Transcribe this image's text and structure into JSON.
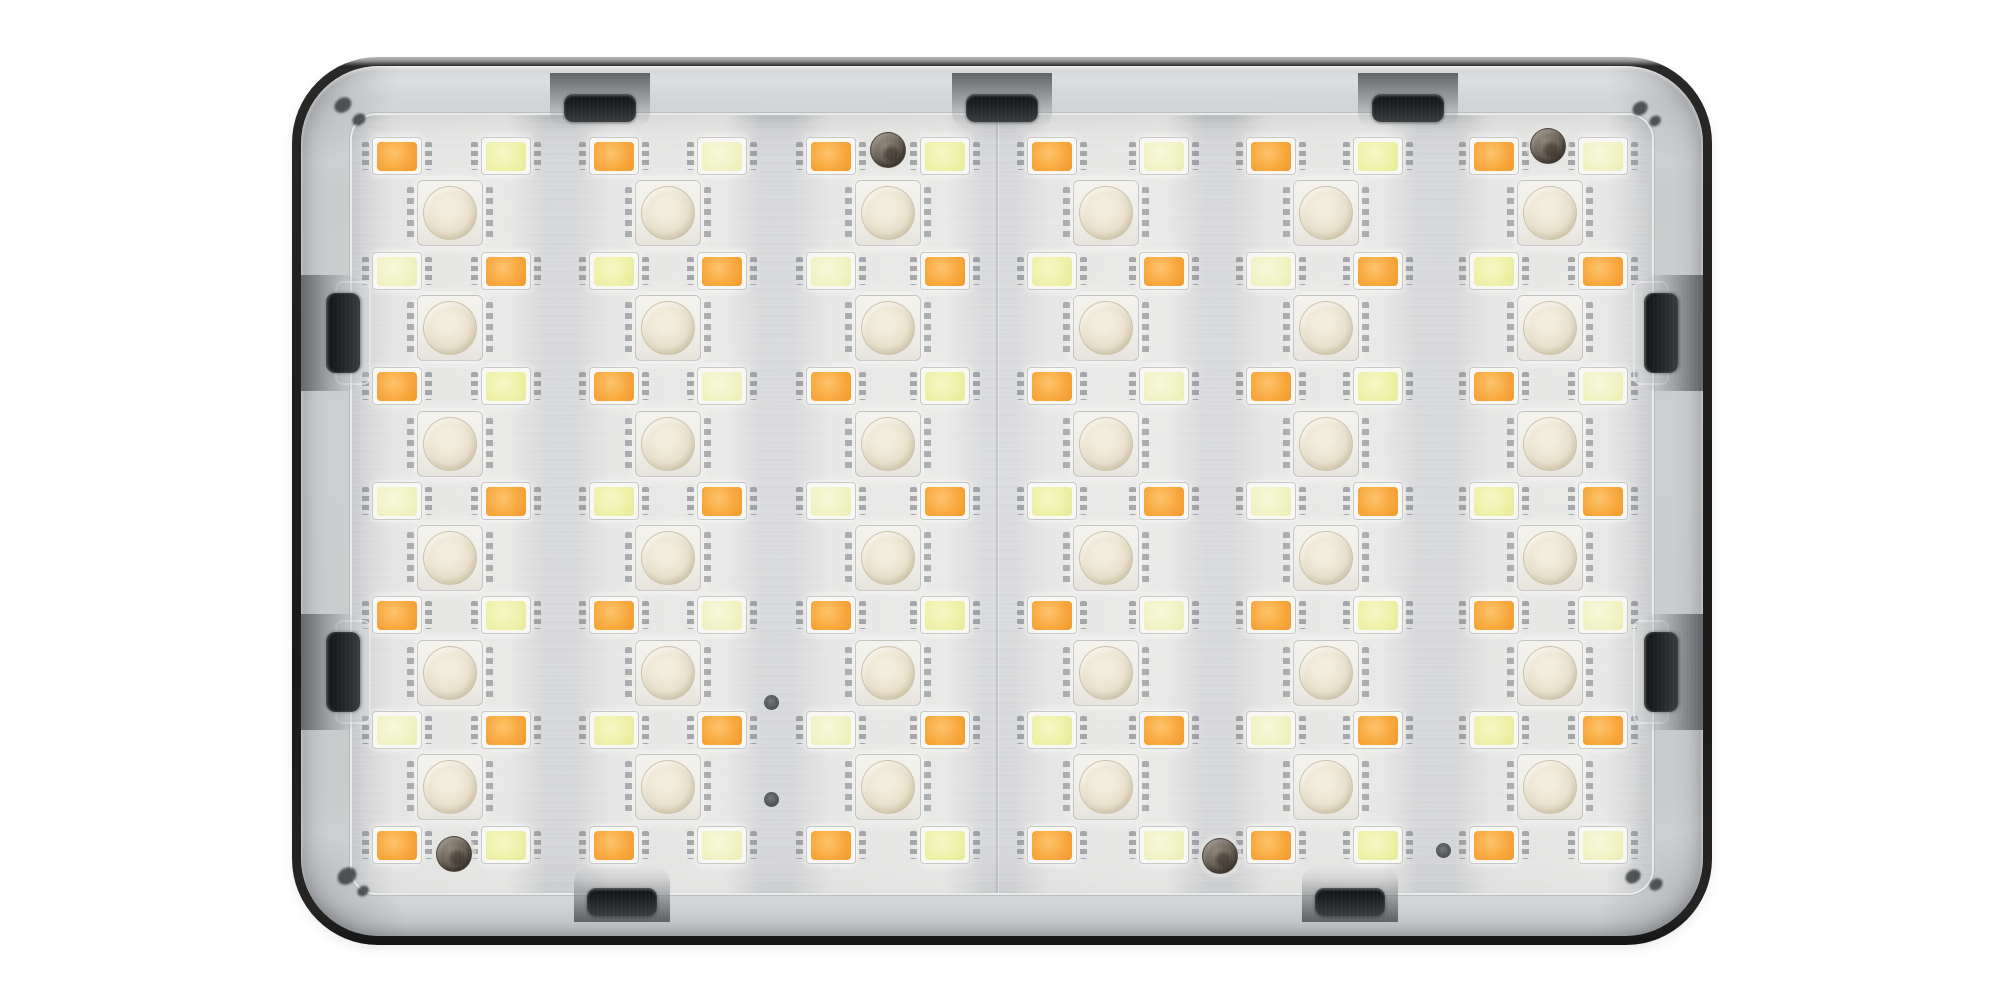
{
  "scene": {
    "description": "Close-up photo of a rectangular pocket LED panel light with a rounded dark frame, silver bezel and a frosted diffuser showing a grid of amber, lime-yellow and white-dome LED chips",
    "background_color": "#ffffff"
  },
  "palette": {
    "frame": "#21201e",
    "bezel": "#c9cbcd",
    "diffuser": "#d6d7d9",
    "orange_led": [
      "#fdc36b",
      "#f8a93e",
      "#ef9729"
    ],
    "lime_led": [
      "#f5f7c6",
      "#eef1a8",
      "#e5e998"
    ],
    "pale_lime_led": [
      "#f7f8dc",
      "#f1f3c6",
      "#e9ecb1"
    ],
    "dome_led": [
      "#f2ecdc",
      "#e8e0ca",
      "#d8cdb0"
    ],
    "screw": [
      "#8e8578",
      "#6e6459",
      "#493f35"
    ],
    "via_dot": [
      "#6a6e71",
      "#3f4346"
    ]
  },
  "grid": {
    "origin": {
      "x": 352,
      "y": 115
    },
    "groups": [
      {
        "left": 397,
        "dome": 450,
        "right": 506
      },
      {
        "left": 614,
        "dome": 668,
        "right": 722
      },
      {
        "left": 831,
        "dome": 888,
        "right": 945
      },
      {
        "left": 1052,
        "dome": 1106,
        "right": 1164
      },
      {
        "left": 1271,
        "dome": 1326,
        "right": 1378
      },
      {
        "left": 1494,
        "dome": 1550,
        "right": 1603
      }
    ],
    "small_rows_y": [
      156,
      271,
      386,
      501,
      615,
      730,
      845
    ],
    "dome_rows_y": [
      213,
      328,
      444,
      558,
      673,
      787
    ],
    "row_pattern": {
      "odd_rows": [
        "orange",
        "lime"
      ],
      "even_rows": [
        "lime",
        "orange"
      ]
    },
    "counts": {
      "small_chips": 84,
      "dome_chips": 36
    }
  },
  "features": {
    "seam_x": 997,
    "screws": [
      {
        "x": 888,
        "y": 150
      },
      {
        "x": 1548,
        "y": 146
      },
      {
        "x": 454,
        "y": 854
      },
      {
        "x": 1220,
        "y": 856
      }
    ],
    "via_dots": [
      {
        "x": 771,
        "y": 702
      },
      {
        "x": 771,
        "y": 799
      },
      {
        "x": 1443,
        "y": 850
      }
    ],
    "corner_marks": [
      {
        "x": 343,
        "y": 107,
        "r": 9
      },
      {
        "x": 359,
        "y": 121,
        "r": 7
      },
      {
        "x": 1640,
        "y": 110,
        "r": 8
      },
      {
        "x": 1655,
        "y": 122,
        "r": 6
      },
      {
        "x": 347,
        "y": 878,
        "r": 10
      },
      {
        "x": 363,
        "y": 892,
        "r": 6
      },
      {
        "x": 1633,
        "y": 878,
        "r": 8
      },
      {
        "x": 1656,
        "y": 886,
        "r": 7
      }
    ],
    "tabs": {
      "top_centers_x": [
        600,
        1002,
        1408
      ],
      "bottom_centers_x": [
        622,
        1350
      ],
      "left_centers_y": [
        333,
        672
      ],
      "right_centers_y": [
        333,
        672
      ]
    }
  }
}
